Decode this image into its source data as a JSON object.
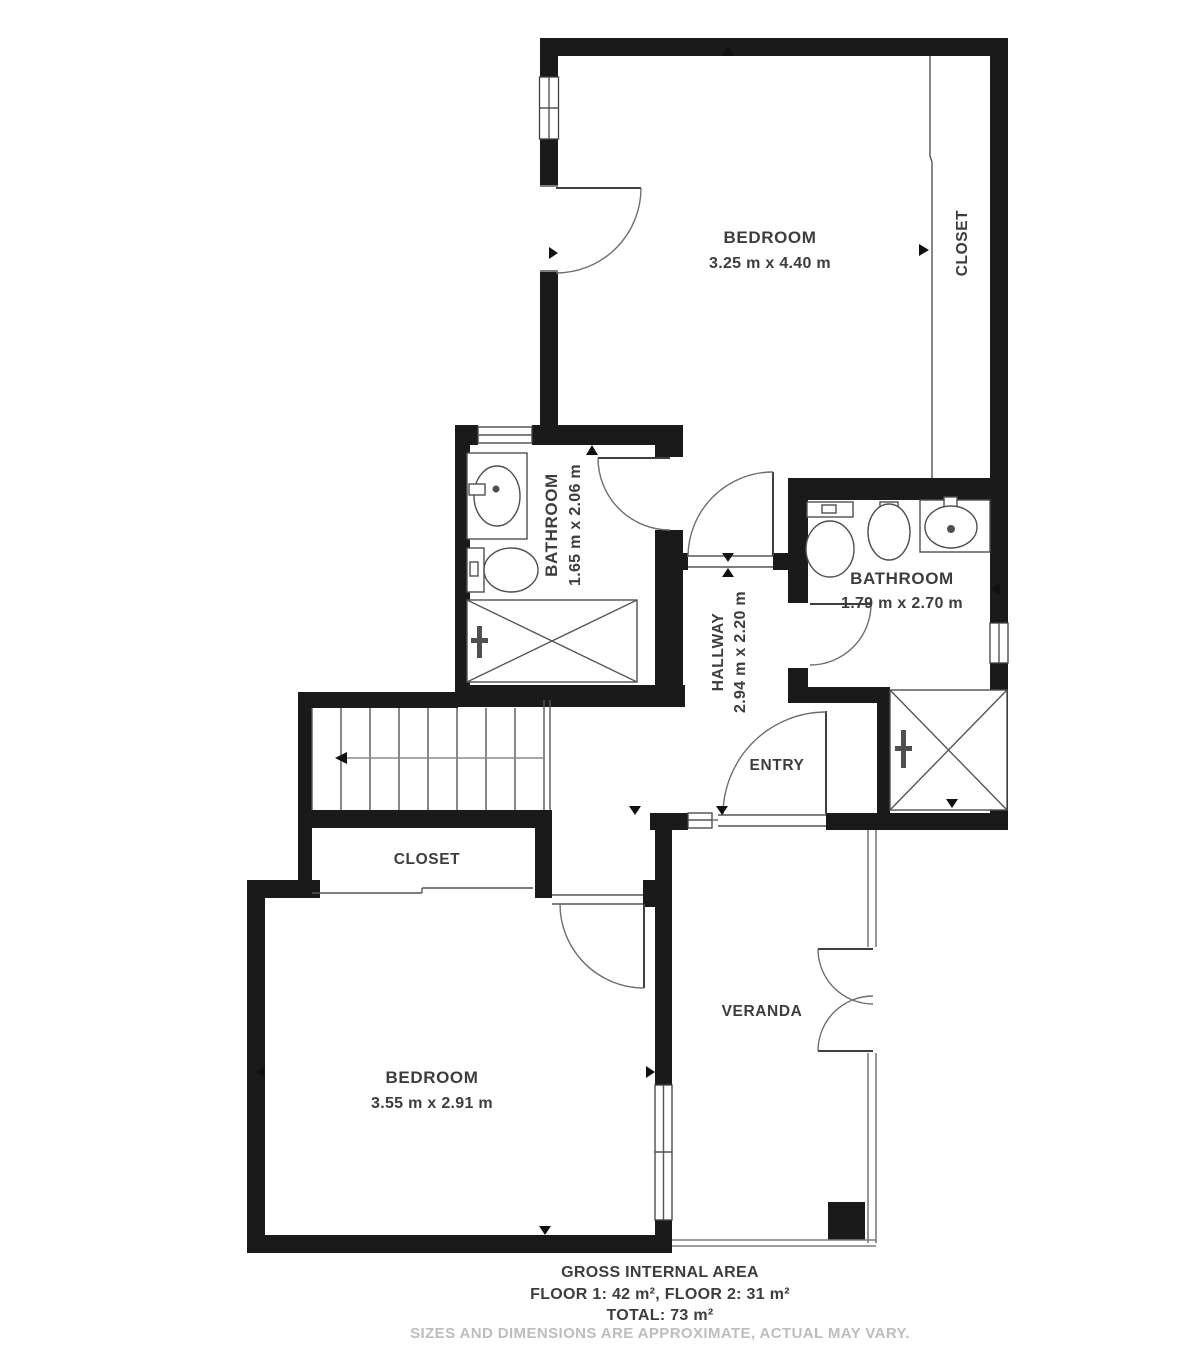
{
  "labels": {
    "bedroom1": {
      "name": "BEDROOM",
      "dims": "3.25 m x 4.40 m"
    },
    "closet1": {
      "name": "CLOSET"
    },
    "bathroom1": {
      "name": "BATHROOM",
      "dims": "1.65 m x 2.06 m"
    },
    "bathroom2": {
      "name": "BATHROOM",
      "dims": "1.79 m x 2.70 m"
    },
    "hallway": {
      "name": "HALLWAY",
      "dims": "2.94 m x 2.20 m"
    },
    "entry": {
      "name": "ENTRY"
    },
    "closet2": {
      "name": "CLOSET"
    },
    "bedroom2": {
      "name": "BEDROOM",
      "dims": "3.55 m x 2.91 m"
    },
    "veranda": {
      "name": "VERANDA"
    }
  },
  "footer": {
    "title": "GROSS INTERNAL AREA",
    "floors": "FLOOR 1: 42 m², FLOOR 2: 31 m²",
    "total": "TOTAL: 73 m²",
    "disclaimer": "SIZES AND DIMENSIONS ARE APPROXIMATE, ACTUAL MAY VARY."
  },
  "colors": {
    "wall": "#1a1a1a",
    "line": "#555555",
    "text": "#3d3d3d",
    "muted": "#bdbdbd"
  }
}
